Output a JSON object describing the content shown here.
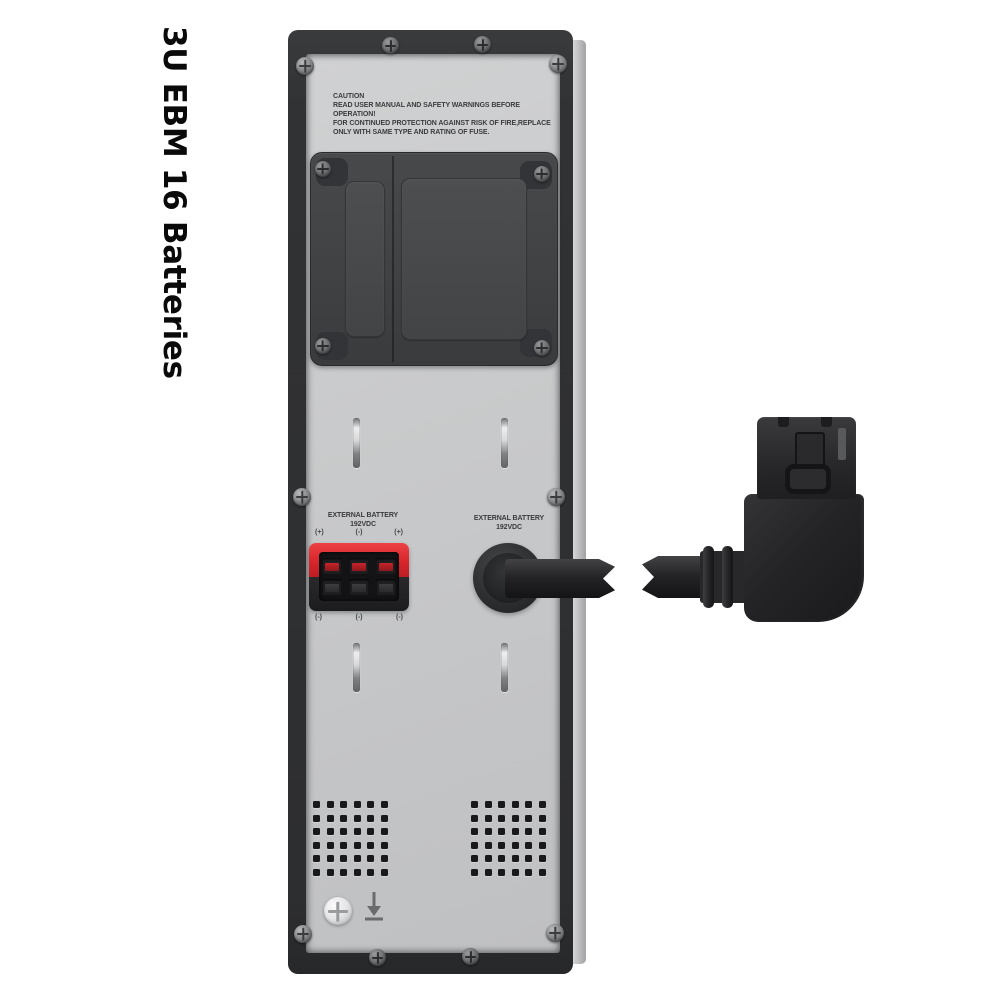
{
  "caption": {
    "title": "3U EBM 16 Batteries"
  },
  "rear_panel": {
    "caution": {
      "heading": "CAUTION",
      "lines": [
        "READ USER MANUAL AND SAFETY WARNINGS BEFORE OPERATION!",
        "FOR CONTINUED PROTECTION AGAINST RISK OF FIRE,REPLACE",
        "ONLY WITH SAME TYPE AND RATING OF FUSE."
      ]
    },
    "left_terminal": {
      "label_line1": "EXTERNAL BATTERY",
      "label_line2": "192VDC",
      "polarity_top": [
        "(+)",
        "(-)",
        "(+)"
      ],
      "polarity_bottom": [
        "(-)",
        "(-)",
        "(-)"
      ]
    },
    "right_port": {
      "label_line1": "EXTERNAL BATTERY",
      "label_line2": "192VDC"
    },
    "colors": {
      "terminal_red": "#d8262c",
      "panel_gray": "#c7c8ca",
      "frame_dark": "#303133",
      "cable_black": "#222224",
      "background_white": "#ffffff"
    }
  }
}
